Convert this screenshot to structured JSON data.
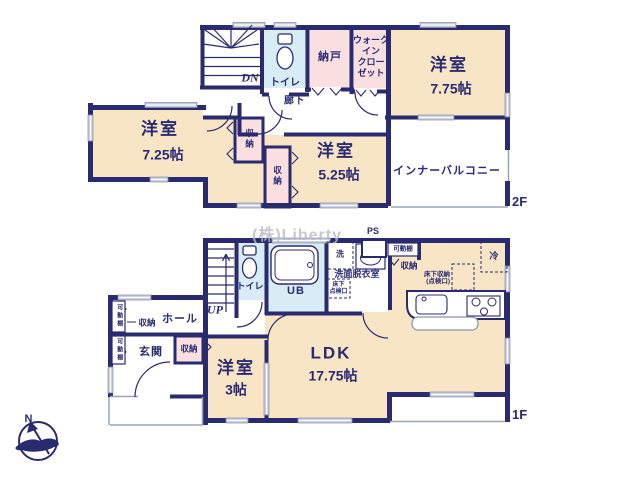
{
  "watermark": "(株)Liberty",
  "compass": {
    "north": "N"
  },
  "colors": {
    "wall": "#2a2a6e",
    "room": "#f7e5c6",
    "closet_pink": "#f9dfdf",
    "wet_blue": "#d8ecf5",
    "window_gray": "#c7ccd8",
    "text": "#2a2a72"
  },
  "floor2": {
    "label": "2F",
    "room_775": {
      "name": "洋室",
      "size": "7.75帖"
    },
    "room_725": {
      "name": "洋室",
      "size": "7.25帖"
    },
    "room_525": {
      "name": "洋室",
      "size": "5.25帖"
    },
    "balcony": "インナーバルコニー",
    "hallway": "廊下",
    "toilet": "トイレ",
    "storeroom": "納戸",
    "wic": {
      "l1": "ウォーク",
      "l2": "イン",
      "l3": "クロー",
      "l4": "ゼット"
    },
    "closet_a": "収納",
    "closet_b": "収納",
    "stairs": "DN"
  },
  "floor1": {
    "label": "1F",
    "ldk": {
      "name": "LDK",
      "size": "17.75帖"
    },
    "room_3": {
      "name": "洋室",
      "size": "3帖"
    },
    "entrance": "玄関",
    "hall": "ホール",
    "hall_closet": "収納",
    "entrance_closet": "収納",
    "shelf_left_top": "可動棚",
    "shelf_left_bottom": "可動棚",
    "toilet": "トイレ",
    "bath": "UB",
    "washroom": "洗面脱衣室",
    "washer": "洗",
    "underfloor_access": {
      "l1": "床下",
      "l2": "点検口"
    },
    "ps": "PS",
    "kitchen_shelf": "可動棚",
    "kitchen_closet": "収納",
    "fridge": "冷",
    "underfloor_storage": {
      "l1": "床下収納",
      "l2": "(点検口)"
    },
    "stairs": "UP"
  }
}
